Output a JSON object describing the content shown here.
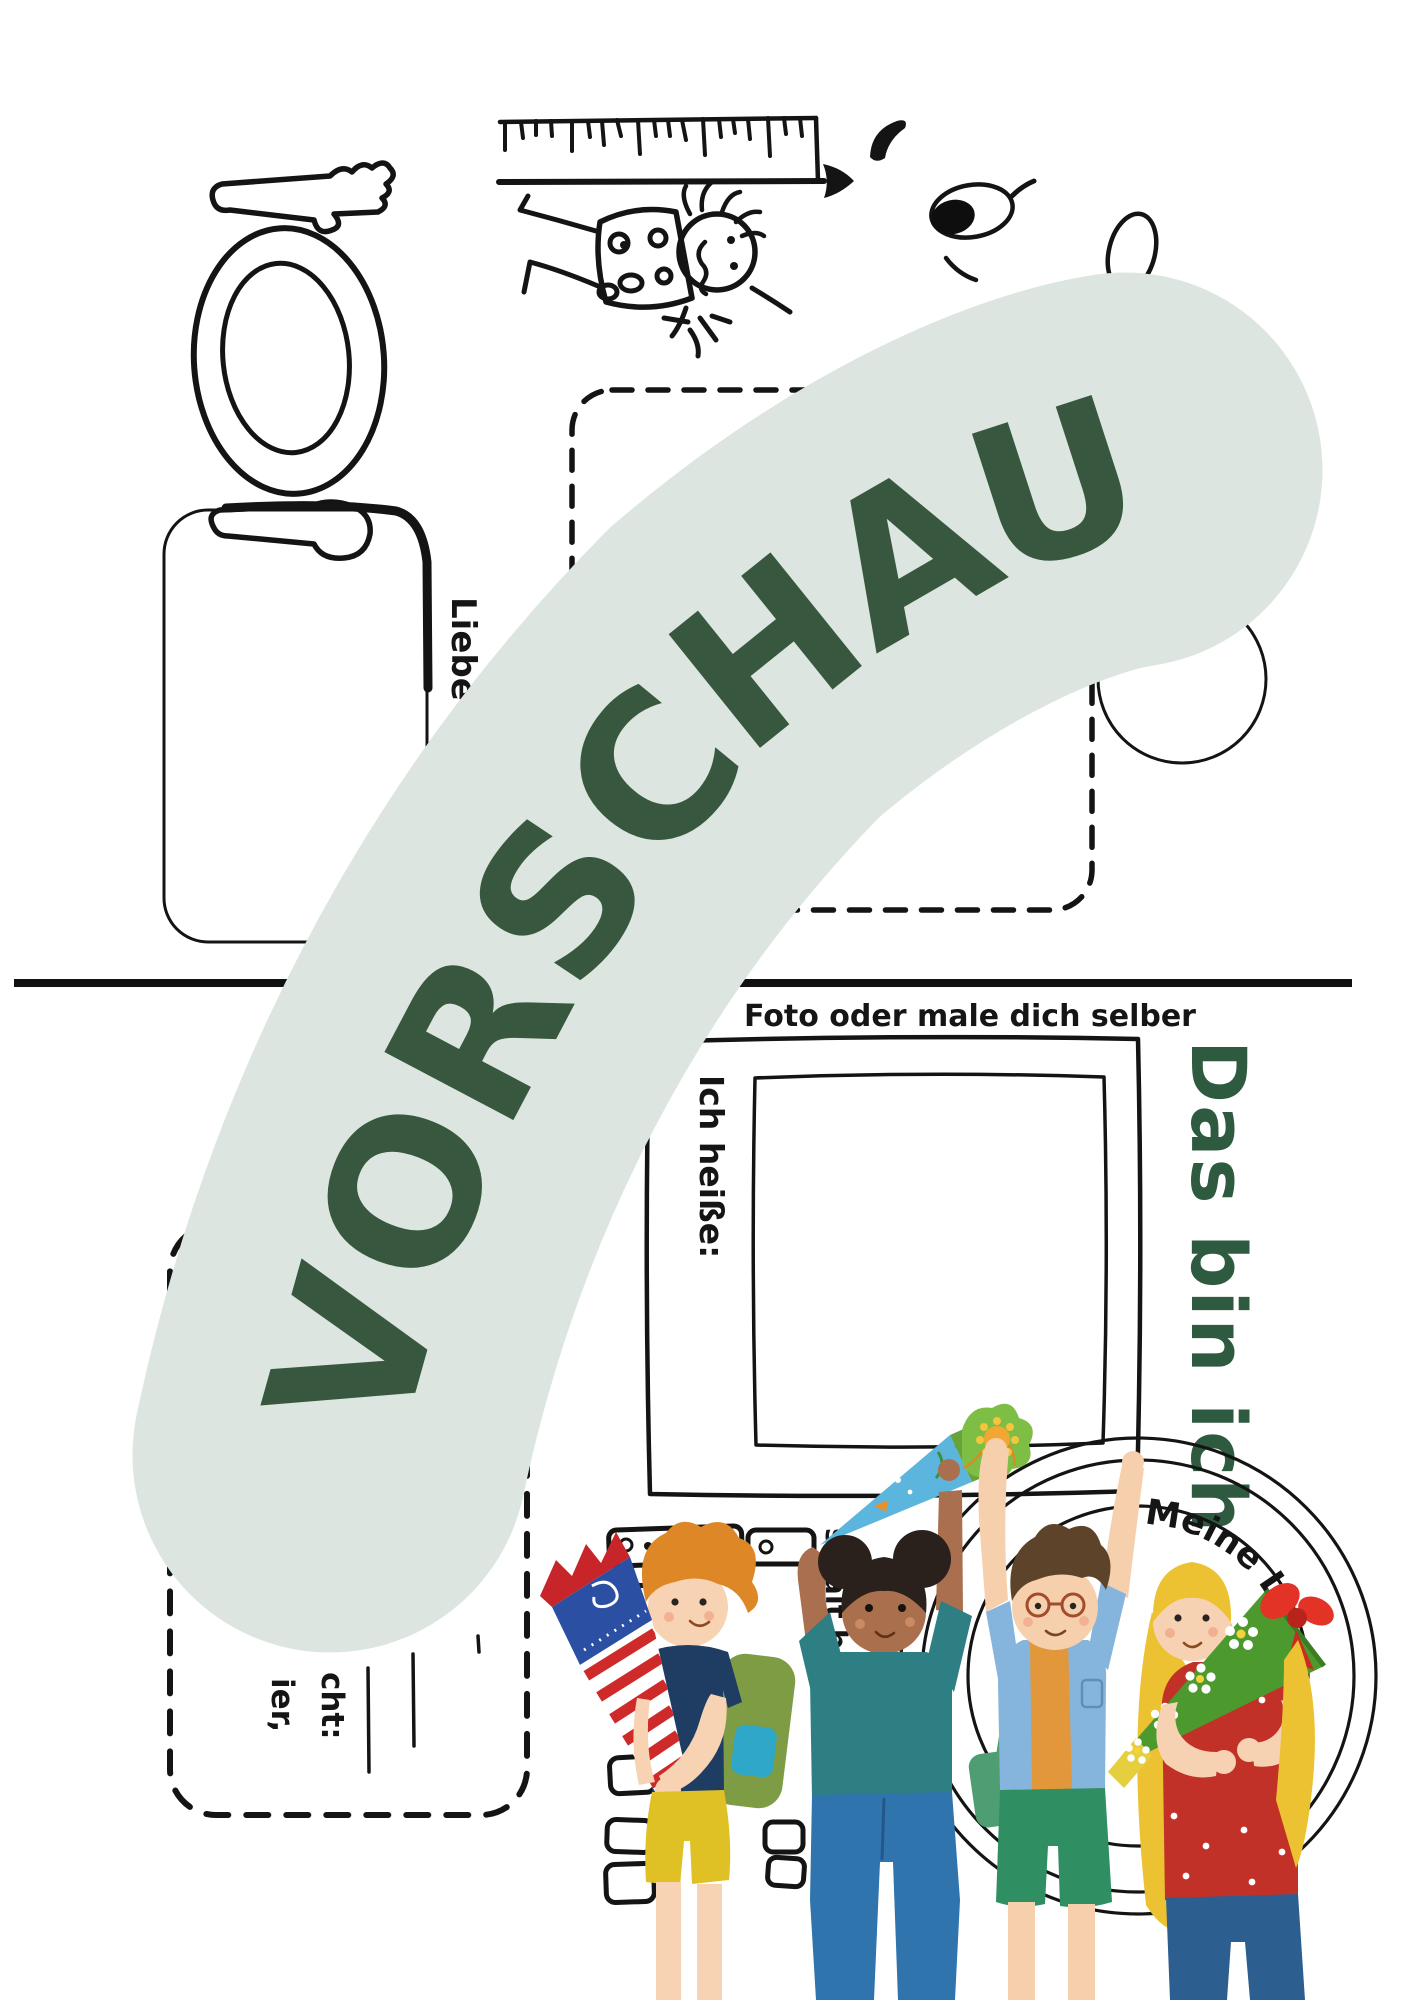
{
  "watermark": {
    "text": "VORSCHAU",
    "band_color": "#dce5df",
    "text_color": "#37583f"
  },
  "page_top": {
    "letter_fragment": "Liebe",
    "drawing_names": [
      "fork-icon",
      "plate-icon",
      "spoon-icon",
      "ruler-arrow-icon",
      "child-doodle",
      "eye-doodle",
      "egg-shape",
      "cutout-dashed-box",
      "rounded-box"
    ]
  },
  "page_bottom": {
    "photo_caption": "Foto oder male dich selber",
    "name_label": "Ich heiße:",
    "page_title": "Das bin ich",
    "circle_caption": "Meine Li",
    "age_fragment": "so alt bi",
    "field_fragments": [
      "ier,",
      "cht:"
    ],
    "illustration": "four-children-with-school-cones"
  },
  "colors": {
    "ink": "#141414",
    "title_green": "#2e5a40",
    "cone1_stripe": "#cf2a2a",
    "cone2_blue": "#5cb5dd",
    "cone4_green": "#4c9a2e"
  }
}
